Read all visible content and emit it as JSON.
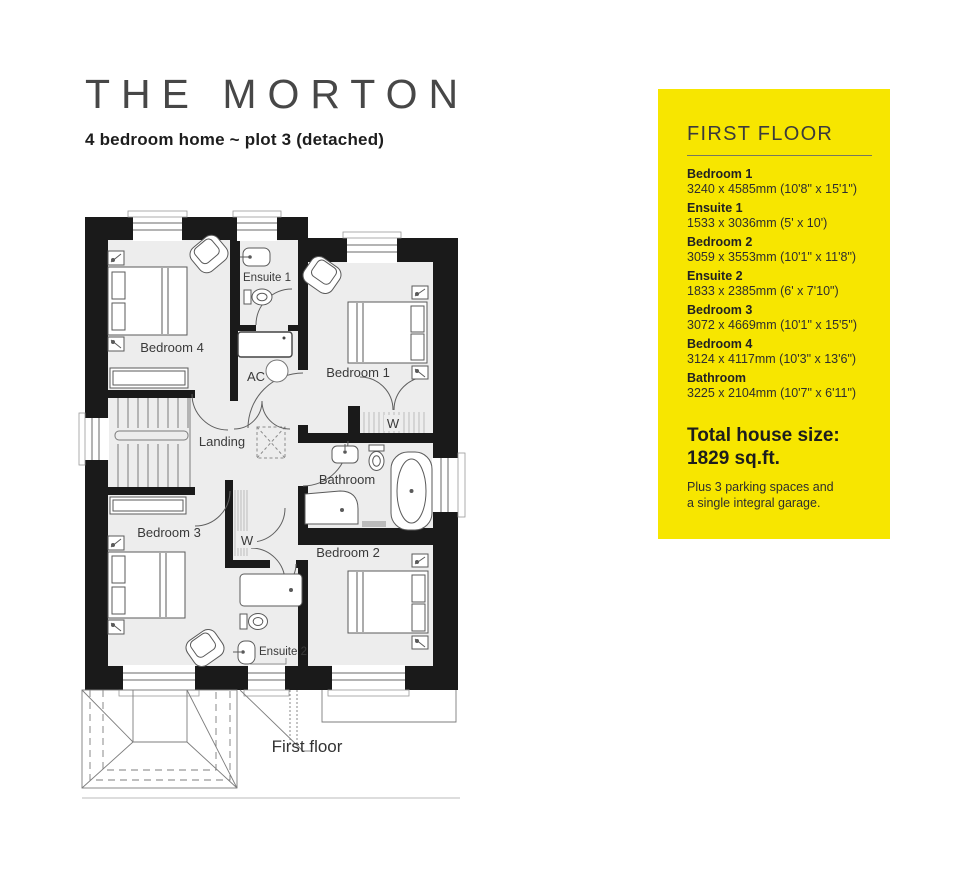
{
  "header": {
    "title": "THE MORTON",
    "subtitle": "4 bedroom home ~ plot 3 (detached)"
  },
  "panel": {
    "background": "#f7e600",
    "heading": "FIRST FLOOR",
    "rooms": [
      {
        "name": "Bedroom 1",
        "dims": "3240 x 4585mm (10'8\" x 15'1\")"
      },
      {
        "name": "Ensuite 1",
        "dims": "1533 x 3036mm (5' x 10')"
      },
      {
        "name": "Bedroom 2",
        "dims": "3059 x 3553mm (10'1\" x 11'8\")"
      },
      {
        "name": "Ensuite 2",
        "dims": "1833 x 2385mm (6' x 7'10\")"
      },
      {
        "name": "Bedroom 3",
        "dims": "3072 x 4669mm (10'1\" x 15'5\")"
      },
      {
        "name": "Bedroom 4",
        "dims": "3124 x 4117mm (10'3\" x 13'6\")"
      },
      {
        "name": "Bathroom",
        "dims": "3225 x 2104mm (10'7\" x 6'11\")"
      }
    ],
    "total_label": "Total house size:",
    "total_value": "1829 sq.ft.",
    "note_line1": "Plus 3 parking spaces and",
    "note_line2": "a single integral garage."
  },
  "plan": {
    "caption": "First floor",
    "labels": {
      "bedroom1": "Bedroom 1",
      "bedroom2": "Bedroom 2",
      "bedroom3": "Bedroom 3",
      "bedroom4": "Bedroom 4",
      "ensuite1": "Ensuite 1",
      "ensuite2": "Ensuite 2",
      "bathroom": "Bathroom",
      "landing": "Landing",
      "ac": "AC",
      "wardrobe": "W"
    }
  },
  "colors": {
    "wall": "#1a1a1a",
    "floor": "#ededed",
    "furniture_stroke": "#5a5a5a",
    "accent_yellow": "#f7e600"
  }
}
